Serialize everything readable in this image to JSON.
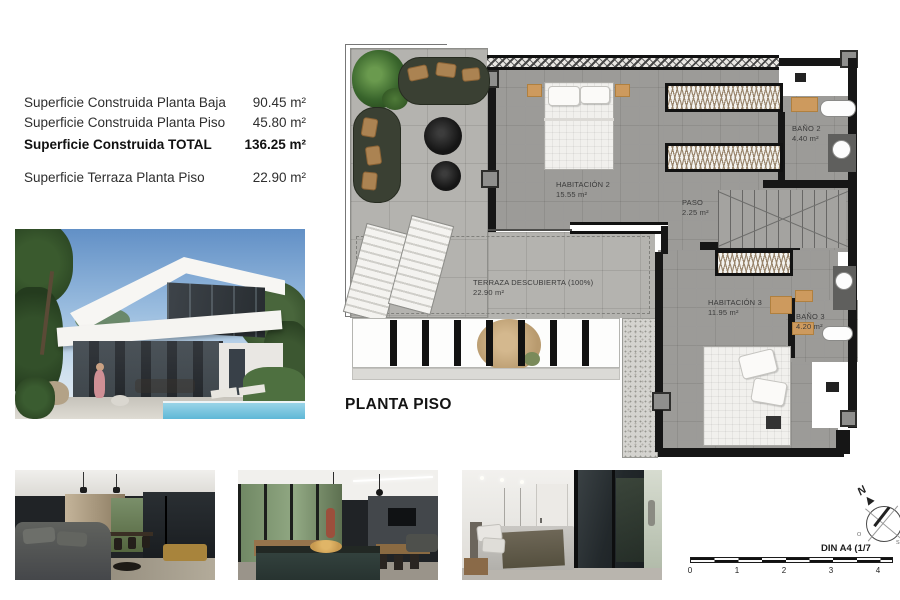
{
  "document": {
    "plan_title": "PLANTA PISO"
  },
  "specs": {
    "rows": [
      {
        "label": "Superficie Construida Planta Baja",
        "value": "90.45 m²"
      },
      {
        "label": "Superficie Construida Planta Piso",
        "value": "45.80 m²"
      },
      {
        "label": "Superficie Construida TOTAL",
        "value": "136.25 m²"
      },
      {
        "label": "Superficie Terraza Planta Piso",
        "value": "22.90 m²"
      }
    ]
  },
  "plan": {
    "rooms": {
      "habitacion2": {
        "name": "HABITACIÓN 2",
        "area": "15.55 m²"
      },
      "paso": {
        "name": "PASO",
        "area": "2.25 m²"
      },
      "bano2": {
        "name": "BAÑO 2",
        "area": "4.40 m²"
      },
      "habitacion3": {
        "name": "HABITACIÓN 3",
        "area": "11.95 m²"
      },
      "bano3": {
        "name": "BAÑO 3",
        "area": "4.20 m²"
      },
      "terraza": {
        "name": "TERRAZA DESCUBIERTA (100%)",
        "area": "22.90 m²"
      }
    }
  },
  "compass": {
    "north": "N",
    "east": "E",
    "south": "S",
    "west": "O"
  },
  "scalebar": {
    "sheet_label": "DIN A4 (1/7",
    "ticks": [
      "0",
      "1",
      "2",
      "3",
      "4"
    ]
  },
  "colors": {
    "wall": "#161616",
    "floor_interior": "#9c9b98",
    "floor_terrace": "#b4b3af",
    "accent_wood": "#cd9a5e"
  }
}
